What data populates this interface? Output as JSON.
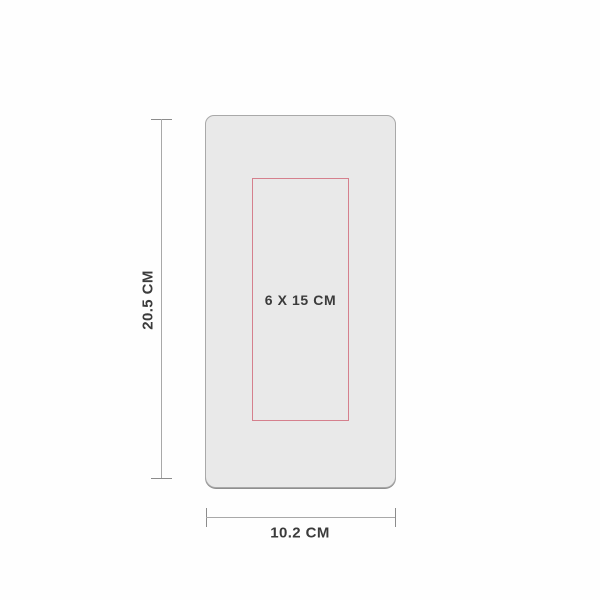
{
  "diagram": {
    "height_label": "20.5 CM",
    "width_label": "10.2 CM",
    "print_area_label": "6 X 15 CM"
  },
  "colors": {
    "background": "#fefefe",
    "product_fill": "#e9e9e9",
    "product_border": "#a9a9a9",
    "product_bottom_edge": "#8f8f8f",
    "print_area_border": "#d5808d",
    "dimension_line": "#a9a9a9",
    "dimension_tick": "#8c8c8c",
    "text": "#3b3b3b"
  }
}
